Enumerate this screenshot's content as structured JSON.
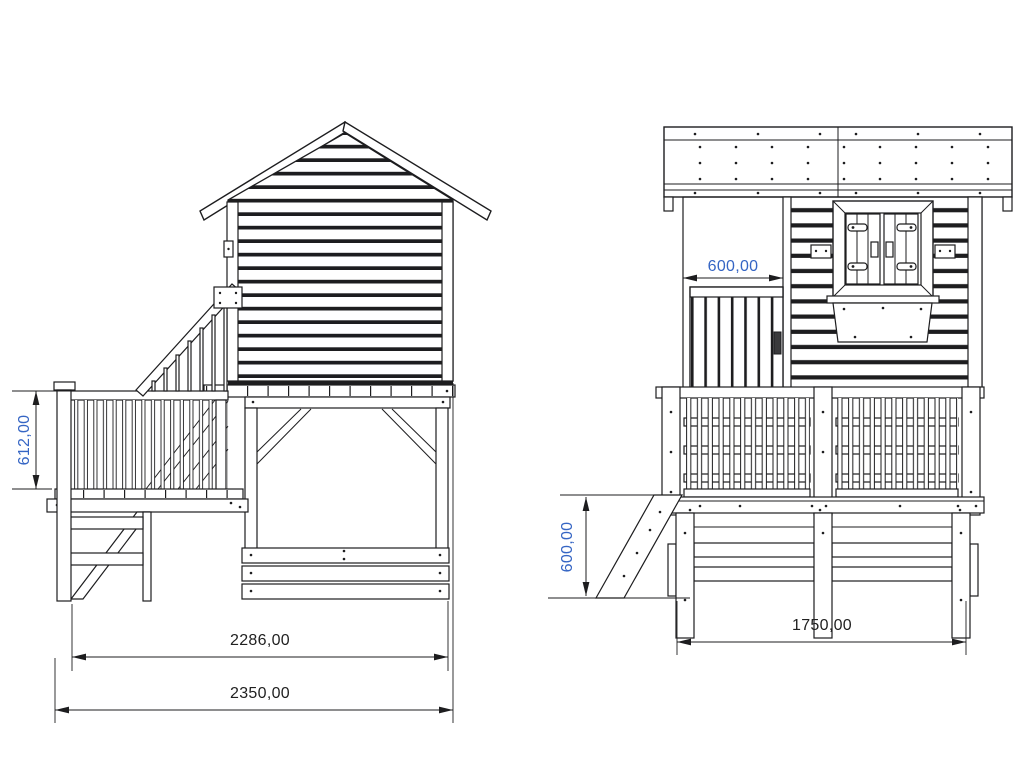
{
  "drawing": {
    "type": "technical-drawing",
    "subject": "wooden-playhouse-elevations",
    "colors": {
      "background": "#ffffff",
      "line": "#1d1d1f",
      "dim_blue": "#3565c4",
      "dim_black": "#212121"
    },
    "views": {
      "side": {
        "dims": [
          {
            "id": "railing-height",
            "value": "612,00",
            "orientation": "vertical"
          },
          {
            "id": "deck-length",
            "value": "2286,00",
            "orientation": "horizontal"
          },
          {
            "id": "overall-length",
            "value": "2350,00",
            "orientation": "horizontal"
          }
        ]
      },
      "front": {
        "dims": [
          {
            "id": "door-width",
            "value": "600,00",
            "orientation": "horizontal"
          },
          {
            "id": "platform-height",
            "value": "600,00",
            "orientation": "vertical"
          },
          {
            "id": "overall-width",
            "value": "1750,00",
            "orientation": "horizontal"
          }
        ]
      }
    }
  }
}
